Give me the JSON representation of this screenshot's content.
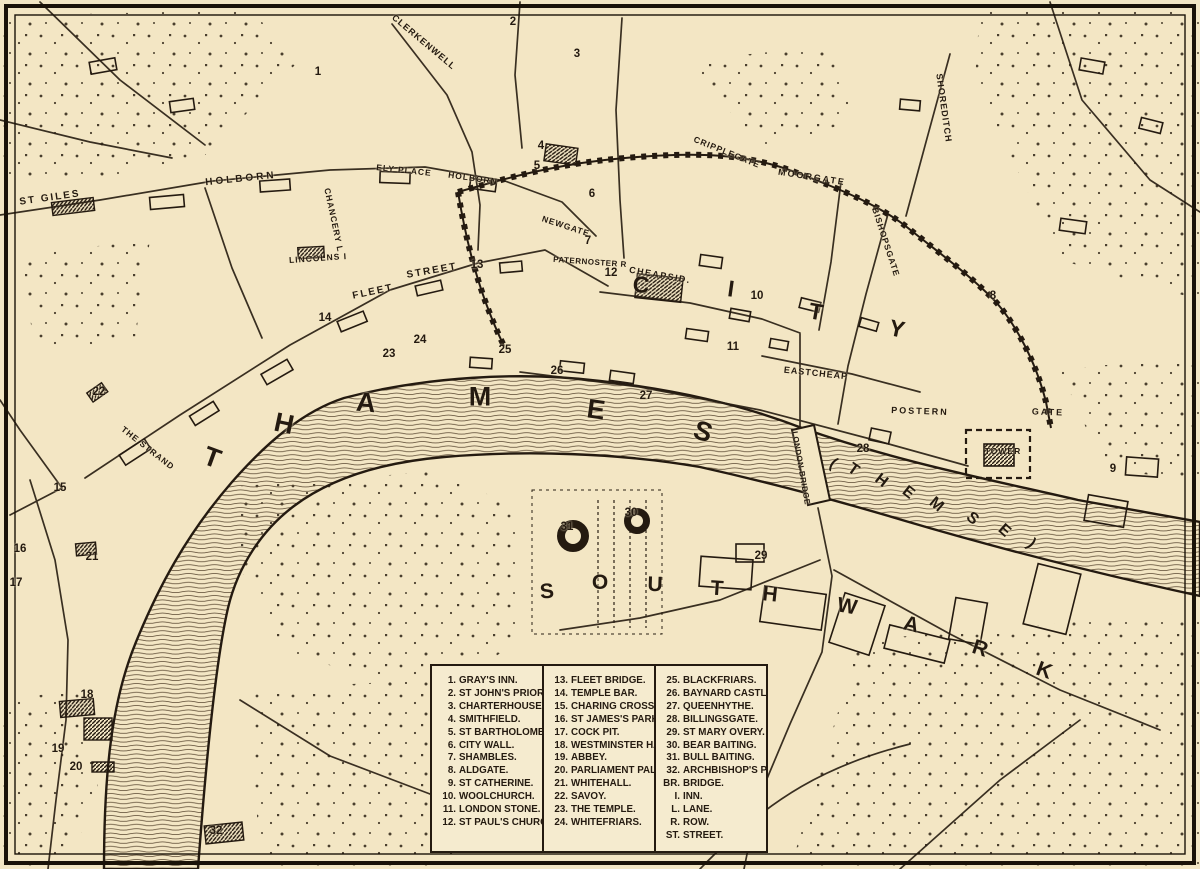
{
  "map": {
    "colors": {
      "paper": "#f3e6c4",
      "ink": "#241a10"
    },
    "river": {
      "name": "THAMES",
      "alt_name": "(THEMSE)",
      "letters": [
        {
          "ch": "T",
          "x": 212,
          "y": 458,
          "rot": 20
        },
        {
          "ch": "H",
          "x": 284,
          "y": 424,
          "rot": 12
        },
        {
          "ch": "A",
          "x": 366,
          "y": 403,
          "rot": 5
        },
        {
          "ch": "M",
          "x": 480,
          "y": 397,
          "rot": 0
        },
        {
          "ch": "E",
          "x": 596,
          "y": 410,
          "rot": 8
        },
        {
          "ch": "S",
          "x": 703,
          "y": 432,
          "rot": 18
        }
      ],
      "alt_letters": [
        {
          "ch": "(",
          "x": 833,
          "y": 464,
          "rot": 35
        },
        {
          "ch": "T",
          "x": 853,
          "y": 470,
          "rot": 35
        },
        {
          "ch": "H",
          "x": 881,
          "y": 481,
          "rot": 38
        },
        {
          "ch": "E",
          "x": 908,
          "y": 493,
          "rot": 38
        },
        {
          "ch": "M",
          "x": 936,
          "y": 505,
          "rot": 40
        },
        {
          "ch": "S",
          "x": 972,
          "y": 519,
          "rot": 42
        },
        {
          "ch": "E",
          "x": 1004,
          "y": 531,
          "rot": 42
        },
        {
          "ch": ")",
          "x": 1031,
          "y": 544,
          "rot": 45
        }
      ]
    },
    "districts": {
      "city": {
        "name": "CITY",
        "letters": [
          {
            "ch": "C",
            "x": 641,
            "y": 285,
            "rot": 5
          },
          {
            "ch": "I",
            "x": 731,
            "y": 289,
            "rot": 8
          },
          {
            "ch": "T",
            "x": 816,
            "y": 312,
            "rot": 10
          },
          {
            "ch": "Y",
            "x": 897,
            "y": 329,
            "rot": 12
          }
        ]
      },
      "southwark": {
        "name": "SOUTHWARK",
        "letters": [
          {
            "ch": "S",
            "x": 547,
            "y": 592,
            "rot": -5
          },
          {
            "ch": "O",
            "x": 600,
            "y": 583,
            "rot": 0
          },
          {
            "ch": "U",
            "x": 655,
            "y": 585,
            "rot": 2
          },
          {
            "ch": "T",
            "x": 717,
            "y": 589,
            "rot": 4
          },
          {
            "ch": "H",
            "x": 770,
            "y": 595,
            "rot": 6
          },
          {
            "ch": "W",
            "x": 847,
            "y": 607,
            "rot": 10
          },
          {
            "ch": "A",
            "x": 911,
            "y": 625,
            "rot": 14
          },
          {
            "ch": "R",
            "x": 980,
            "y": 649,
            "rot": 18
          },
          {
            "ch": "K",
            "x": 1044,
            "y": 671,
            "rot": 20
          }
        ]
      }
    },
    "streets": [
      {
        "text": "ST GILES",
        "x": 50,
        "y": 198,
        "rot": -8,
        "size": 10,
        "sp": 2
      },
      {
        "text": "HOLBORN",
        "x": 241,
        "y": 179,
        "rot": -6,
        "size": 10,
        "sp": 3
      },
      {
        "text": "CLERKENWELL",
        "x": 424,
        "y": 42,
        "rot": 40,
        "size": 9,
        "sp": 1
      },
      {
        "text": "ELY PLACE",
        "x": 404,
        "y": 170,
        "rot": 6,
        "size": 8.5,
        "sp": 1
      },
      {
        "text": "HOLBORN",
        "x": 473,
        "y": 178,
        "rot": 8,
        "size": 8.5,
        "sp": 1
      },
      {
        "text": "CHANCERY L",
        "x": 334,
        "y": 220,
        "rot": 78,
        "size": 8.5,
        "sp": 1
      },
      {
        "text": "LINCOLNS I",
        "x": 318,
        "y": 258,
        "rot": -4,
        "size": 8.5,
        "sp": 1
      },
      {
        "text": "FLEET",
        "x": 373,
        "y": 292,
        "rot": -12,
        "size": 10,
        "sp": 2
      },
      {
        "text": "STREET",
        "x": 432,
        "y": 271,
        "rot": -10,
        "size": 10,
        "sp": 2
      },
      {
        "text": "NEWGATE",
        "x": 566,
        "y": 226,
        "rot": 18,
        "size": 8.5,
        "sp": 1
      },
      {
        "text": "PATERNOSTER R",
        "x": 590,
        "y": 262,
        "rot": 4,
        "size": 8,
        "sp": 0.5
      },
      {
        "text": "CHEAPSID.",
        "x": 660,
        "y": 275,
        "rot": 10,
        "size": 9,
        "sp": 1.5
      },
      {
        "text": "CRIPPLEGATE",
        "x": 727,
        "y": 152,
        "rot": 22,
        "size": 8.5,
        "sp": 1
      },
      {
        "text": "MOORGATE",
        "x": 812,
        "y": 177,
        "rot": 9,
        "size": 9,
        "sp": 2
      },
      {
        "text": "SHOREDITCH",
        "x": 944,
        "y": 108,
        "rot": 82,
        "size": 9,
        "sp": 1
      },
      {
        "text": "BISHOPSGATE",
        "x": 886,
        "y": 242,
        "rot": 72,
        "size": 8.5,
        "sp": 1
      },
      {
        "text": "EASTCHEAP",
        "x": 816,
        "y": 373,
        "rot": 6,
        "size": 9,
        "sp": 1
      },
      {
        "text": "LONDON BRIDGE",
        "x": 801,
        "y": 468,
        "rot": 80,
        "size": 8,
        "sp": 0.5
      },
      {
        "text": "POSTERN",
        "x": 920,
        "y": 411,
        "rot": 2,
        "size": 9,
        "sp": 2
      },
      {
        "text": "GATE",
        "x": 1048,
        "y": 412,
        "rot": 2,
        "size": 9,
        "sp": 2
      },
      {
        "text": "TOWER",
        "x": 1003,
        "y": 451,
        "rot": 0,
        "size": 8.5,
        "sp": 1
      },
      {
        "text": "THE STRAND",
        "x": 148,
        "y": 448,
        "rot": 38,
        "size": 8.5,
        "sp": 1
      }
    ],
    "markers": [
      {
        "n": 1,
        "name": "Gray's Inn",
        "x": 318,
        "y": 72
      },
      {
        "n": 2,
        "name": "St John's Priory",
        "x": 513,
        "y": 22
      },
      {
        "n": 3,
        "name": "Charterhouse",
        "x": 577,
        "y": 54
      },
      {
        "n": 4,
        "name": "Smithfield",
        "x": 541,
        "y": 146
      },
      {
        "n": 5,
        "name": "St Bartholomew",
        "x": 537,
        "y": 166
      },
      {
        "n": 6,
        "name": "City Wall",
        "x": 592,
        "y": 194
      },
      {
        "n": 7,
        "name": "Shambles",
        "x": 588,
        "y": 241
      },
      {
        "n": 8,
        "name": "Aldgate",
        "x": 993,
        "y": 296
      },
      {
        "n": 9,
        "name": "St Catherine",
        "x": 1113,
        "y": 469
      },
      {
        "n": 10,
        "name": "Woolchurch",
        "x": 757,
        "y": 296
      },
      {
        "n": 11,
        "name": "London Stone",
        "x": 733,
        "y": 347
      },
      {
        "n": 12,
        "name": "St Paul's Church",
        "x": 611,
        "y": 273
      },
      {
        "n": 13,
        "name": "Fleet Bridge",
        "x": 477,
        "y": 265
      },
      {
        "n": 14,
        "name": "Temple Bar",
        "x": 325,
        "y": 318
      },
      {
        "n": 15,
        "name": "Charing Cross",
        "x": 60,
        "y": 488
      },
      {
        "n": 16,
        "name": "St James's Park",
        "x": 20,
        "y": 549
      },
      {
        "n": 17,
        "name": "Cock Pit",
        "x": 16,
        "y": 583
      },
      {
        "n": 18,
        "name": "Westminster Hall",
        "x": 87,
        "y": 695
      },
      {
        "n": 19,
        "name": "Abbey",
        "x": 58,
        "y": 749
      },
      {
        "n": 20,
        "name": "Parliament Pal.",
        "x": 76,
        "y": 767
      },
      {
        "n": 21,
        "name": "Whitehall",
        "x": 92,
        "y": 557
      },
      {
        "n": 22,
        "name": "Savoy",
        "x": 99,
        "y": 392
      },
      {
        "n": 23,
        "name": "The Temple",
        "x": 389,
        "y": 354
      },
      {
        "n": 24,
        "name": "Whitefriars",
        "x": 420,
        "y": 340
      },
      {
        "n": 25,
        "name": "Blackfriars",
        "x": 505,
        "y": 350
      },
      {
        "n": 26,
        "name": "Baynard Castle",
        "x": 557,
        "y": 371
      },
      {
        "n": 27,
        "name": "Queenhythe",
        "x": 646,
        "y": 396
      },
      {
        "n": 28,
        "name": "Billingsgate",
        "x": 863,
        "y": 449
      },
      {
        "n": 29,
        "name": "St Mary Overy",
        "x": 761,
        "y": 556
      },
      {
        "n": 30,
        "name": "Bear Baiting",
        "x": 631,
        "y": 513
      },
      {
        "n": 31,
        "name": "Bull Baiting",
        "x": 567,
        "y": 527
      },
      {
        "n": 32,
        "name": "Archbishop's P.",
        "x": 216,
        "y": 831
      }
    ],
    "legend": {
      "columns": [
        [
          {
            "num": "1.",
            "name": "GRAY'S INN."
          },
          {
            "num": "2.",
            "name": "ST JOHN'S PRIORY"
          },
          {
            "num": "3.",
            "name": "CHARTERHOUSE."
          },
          {
            "num": "4.",
            "name": "SMITHFIELD."
          },
          {
            "num": "5.",
            "name": "ST BARTHOLOMEW."
          },
          {
            "num": "6.",
            "name": "CITY WALL."
          },
          {
            "num": "7.",
            "name": "SHAMBLES."
          },
          {
            "num": "8.",
            "name": "ALDGATE."
          },
          {
            "num": "9.",
            "name": "ST CATHERINE."
          },
          {
            "num": "10.",
            "name": "WOOLCHURCH."
          },
          {
            "num": "11.",
            "name": "LONDON STONE."
          },
          {
            "num": "12.",
            "name": "ST PAUL'S CHURCH."
          }
        ],
        [
          {
            "num": "13.",
            "name": "FLEET BRIDGE."
          },
          {
            "num": "14.",
            "name": "TEMPLE BAR."
          },
          {
            "num": "15.",
            "name": "CHARING CROSS."
          },
          {
            "num": "16.",
            "name": "ST JAMES'S PARK."
          },
          {
            "num": "17.",
            "name": "COCK PIT."
          },
          {
            "num": "18.",
            "name": "WESTMINSTER HALL"
          },
          {
            "num": "19.",
            "name": "ABBEY."
          },
          {
            "num": "20.",
            "name": "PARLIAMENT PAL."
          },
          {
            "num": "21.",
            "name": "WHITEHALL."
          },
          {
            "num": "22.",
            "name": "SAVOY."
          },
          {
            "num": "23.",
            "name": "THE TEMPLE."
          },
          {
            "num": "24.",
            "name": "WHITEFRIARS."
          }
        ],
        [
          {
            "num": "25.",
            "name": "BLACKFRIARS."
          },
          {
            "num": "26.",
            "name": "BAYNARD CASTLE."
          },
          {
            "num": "27.",
            "name": "QUEENHYTHE."
          },
          {
            "num": "28.",
            "name": "BILLINGSGATE."
          },
          {
            "num": "29.",
            "name": "ST MARY OVERY."
          },
          {
            "num": "30.",
            "name": "BEAR BAITING."
          },
          {
            "num": "31.",
            "name": "BULL BAITING."
          },
          {
            "num": "32.",
            "name": "ARCHBISHOP'S P."
          },
          {
            "num": "BR.",
            "name": "BRIDGE."
          },
          {
            "num": "I.",
            "name": "INN."
          },
          {
            "num": "L.",
            "name": "LANE."
          },
          {
            "num": "R.",
            "name": "ROW."
          },
          {
            "num": "ST.",
            "name": "STREET."
          }
        ]
      ]
    }
  }
}
